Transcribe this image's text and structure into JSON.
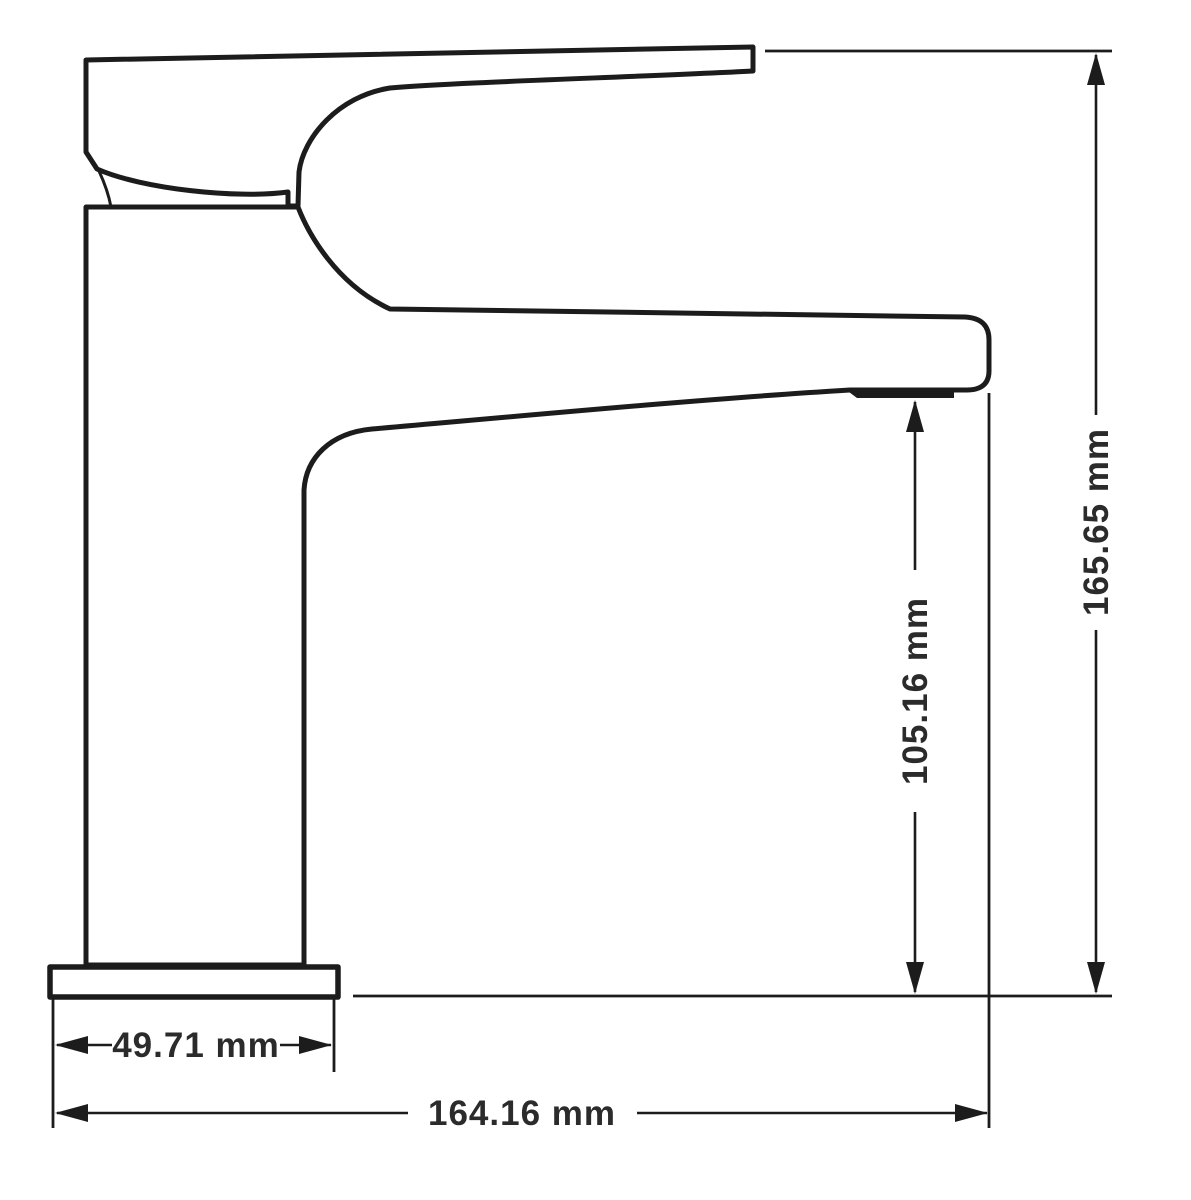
{
  "drawing": {
    "subject": "single-lever-basin-faucet-side-profile",
    "view": "technical dimension drawing"
  },
  "dimensions": {
    "total_height": {
      "value": "165.65 mm",
      "orientation": "vertical"
    },
    "spout_height": {
      "value": "105.16 mm",
      "orientation": "vertical"
    },
    "base_width": {
      "value": "49.71 mm",
      "orientation": "horizontal"
    },
    "total_width": {
      "value": "164.16 mm",
      "orientation": "horizontal"
    }
  },
  "colors": {
    "line": "#1c1c1c",
    "label": "#2b2b2b",
    "background": "#ffffff"
  }
}
